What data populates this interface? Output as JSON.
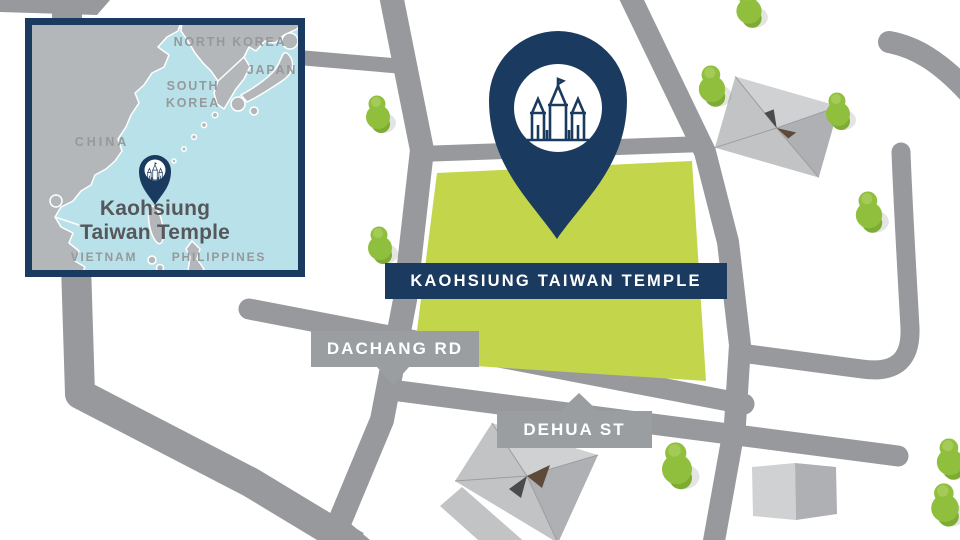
{
  "colors": {
    "navy": "#1b3a60",
    "lime": "#c3d64b",
    "road": "#97999c",
    "banner_gray": "#9b9ea1",
    "sea": "#b9e1ea",
    "land": "#b4b7b9",
    "tree": "#90bf3d",
    "tree_dark": "#7dab34",
    "tree_light": "#a4cb58",
    "ink": "#55575b",
    "country": "#96999c"
  },
  "inset": {
    "labels": {
      "north_korea": "NORTH KOREA",
      "japan": "JAPAN",
      "south_korea": "SOUTH KOREA",
      "china": "CHINA",
      "vietnam": "VIETNAM",
      "philippines": "PHILIPPINES"
    },
    "temple_name_line1": "Kaohsiung",
    "temple_name_line2": "Taiwan Temple"
  },
  "main": {
    "temple_banner": "KAOHSIUNG TAIWAN TEMPLE",
    "road_dachang": "DACHANG RD",
    "road_dehua": "DEHUA ST"
  },
  "icons": {
    "pin": "map-pin-icon",
    "temple": "temple-icon",
    "tree": "tree-icon"
  }
}
